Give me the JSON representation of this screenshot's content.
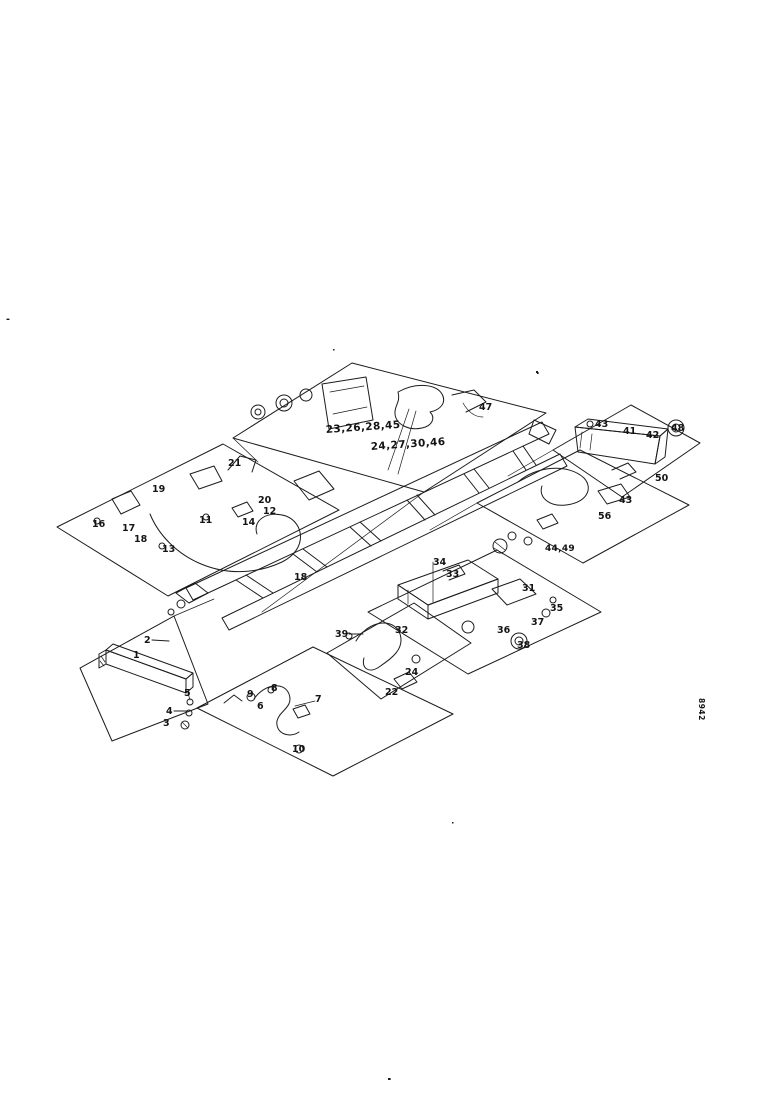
{
  "page": {
    "kind": "scanned exploded-parts diagram",
    "paper_color": "#ffffff",
    "ink_color": "#1c1c1c"
  },
  "figure": {
    "callouts": [
      {
        "text": "23,26,28,45",
        "x": 326,
        "y": 433,
        "cls": "group",
        "rotate": -4
      },
      {
        "text": "24,27,30,46",
        "x": 371,
        "y": 450,
        "cls": "group",
        "rotate": -4
      },
      {
        "text": "47",
        "x": 479,
        "y": 410
      },
      {
        "text": "21",
        "x": 228,
        "y": 466
      },
      {
        "text": "19",
        "x": 152,
        "y": 492
      },
      {
        "text": "16",
        "x": 92,
        "y": 527
      },
      {
        "text": "17",
        "x": 122,
        "y": 531
      },
      {
        "text": "18",
        "x": 134,
        "y": 542
      },
      {
        "text": "13",
        "x": 162,
        "y": 552
      },
      {
        "text": "11",
        "x": 199,
        "y": 523
      },
      {
        "text": "14",
        "x": 242,
        "y": 525
      },
      {
        "text": "12",
        "x": 263,
        "y": 514
      },
      {
        "text": "20",
        "x": 258,
        "y": 503
      },
      {
        "text": "43",
        "x": 595,
        "y": 427
      },
      {
        "text": "41",
        "x": 623,
        "y": 434
      },
      {
        "text": "42",
        "x": 646,
        "y": 438
      },
      {
        "text": "48",
        "x": 671,
        "y": 431
      },
      {
        "text": "50",
        "x": 655,
        "y": 481
      },
      {
        "text": "43",
        "x": 619,
        "y": 503
      },
      {
        "text": "56",
        "x": 598,
        "y": 519
      },
      {
        "text": "44,49",
        "x": 545,
        "y": 551,
        "cls": "group-sm"
      },
      {
        "text": "18",
        "x": 294,
        "y": 580
      },
      {
        "text": "34",
        "x": 433,
        "y": 565
      },
      {
        "text": "33",
        "x": 446,
        "y": 577
      },
      {
        "text": "31",
        "x": 522,
        "y": 591
      },
      {
        "text": "35",
        "x": 550,
        "y": 611
      },
      {
        "text": "37",
        "x": 531,
        "y": 625
      },
      {
        "text": "36",
        "x": 497,
        "y": 633
      },
      {
        "text": "38",
        "x": 517,
        "y": 648
      },
      {
        "text": "39",
        "x": 335,
        "y": 637,
        "leader": [
          349,
          634,
          363,
          634
        ]
      },
      {
        "text": "32",
        "x": 395,
        "y": 633
      },
      {
        "text": "24",
        "x": 405,
        "y": 675
      },
      {
        "text": "22",
        "x": 385,
        "y": 695
      },
      {
        "text": "9",
        "x": 247,
        "y": 697
      },
      {
        "text": "8",
        "x": 271,
        "y": 691
      },
      {
        "text": "6",
        "x": 257,
        "y": 709
      },
      {
        "text": "7",
        "x": 315,
        "y": 702
      },
      {
        "text": "10",
        "x": 292,
        "y": 752
      },
      {
        "text": "2",
        "x": 144,
        "y": 643,
        "leader": [
          152,
          640,
          169,
          641
        ]
      },
      {
        "text": "1",
        "x": 133,
        "y": 658
      },
      {
        "text": "5",
        "x": 184,
        "y": 696
      },
      {
        "text": "4",
        "x": 166,
        "y": 714,
        "leader": [
          174,
          711,
          187,
          711
        ]
      },
      {
        "text": "3",
        "x": 163,
        "y": 726
      },
      {
        "text": "8942",
        "x": 699,
        "y": 698,
        "cls": "tiny",
        "rotate": 90
      },
      {
        "text": "-",
        "x": 6,
        "y": 322
      },
      {
        "text": ".",
        "x": 536,
        "y": 374
      },
      {
        "text": ".",
        "x": 388,
        "y": 1080
      }
    ]
  }
}
